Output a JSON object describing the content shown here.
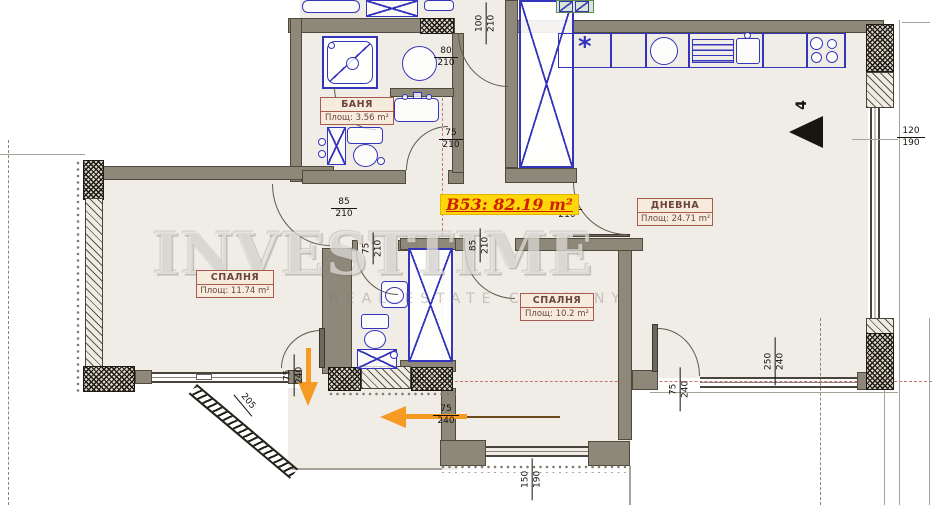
{
  "unit": {
    "label": "B53: 82.19 m²"
  },
  "rooms": [
    {
      "name": "СПАЛНЯ",
      "area": "Площ: 11.74 m²"
    },
    {
      "name": "СПАЛНЯ",
      "area": "Площ: 10.2 m²"
    },
    {
      "name": "ДНЕВНА",
      "area": "Площ: 24.71 m²"
    },
    {
      "name": "БАНЯ",
      "area": "Площ: 3.56 m²"
    }
  ],
  "dimensions": {
    "entry_door": {
      "w": "100",
      "h": "210"
    },
    "bath_recess": {
      "w": "80",
      "h": "210"
    },
    "bath_door": {
      "w": "75",
      "h": "210"
    },
    "bedroom1_door": {
      "w": "85",
      "h": "210"
    },
    "wc_door": {
      "w": "75",
      "h": "210"
    },
    "bedroom2_door": {
      "w": "85",
      "h": "210"
    },
    "living_door": {
      "w": "90",
      "h": "210"
    },
    "right_window": {
      "w": "120",
      "h": "190"
    },
    "terrace_door": {
      "w": "75",
      "h": "240"
    },
    "entrance_door": {
      "w": "75",
      "h": "240"
    },
    "balcony_door": {
      "w": "75",
      "h": "240"
    },
    "balcony_window": {
      "w": "250",
      "h": "240"
    },
    "south_window": {
      "w": "150",
      "h": "190"
    },
    "diagonal_wall_length": "205"
  },
  "north_mark": "4",
  "icons": {
    "hob_star": "*"
  },
  "watermark": {
    "line1": "INVESTTIME",
    "line2": "REAL ESTATE COMPANY"
  },
  "colors": {
    "highlight_bg": "#ffd60a",
    "highlight_text": "#ce2000",
    "fixture_blue": "#3434bc",
    "arrow_orange": "#f59a23",
    "wall_gray": "#8e887a",
    "axis_red": "#c4766a"
  }
}
